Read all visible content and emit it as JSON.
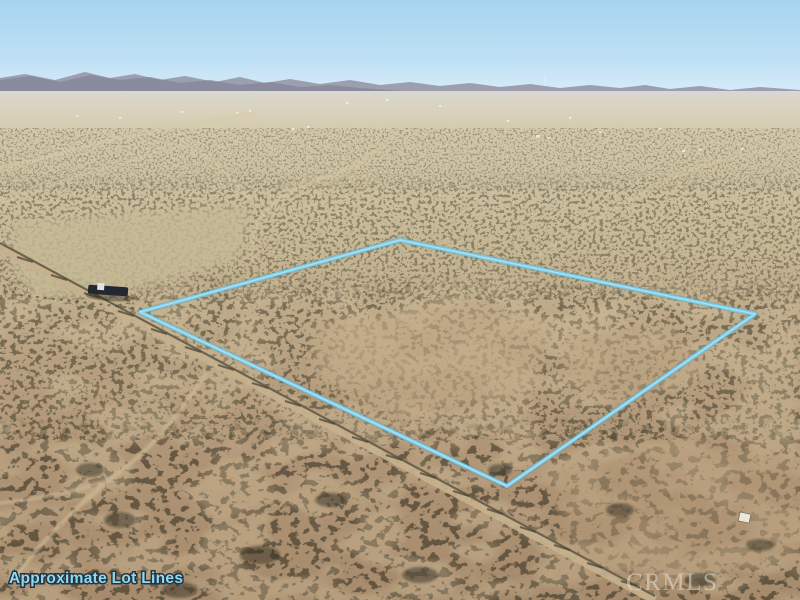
{
  "photo": {
    "type": "aerial-drone-photo",
    "description": "Aerial drone view of a vacant desert land parcel with mountains on the horizon, dirt roads, scattered scrub brush, and an outlined lot boundary",
    "overlay_label": "Approximate Lot Lines",
    "watermark": "CRMLS",
    "colors": {
      "lot_line": "#79cbe8",
      "lot_line_highlight": "#b4e4f4",
      "label_text": "#8ed9f4",
      "label_outline": "#26343f",
      "watermark_text": "#e8e8e4",
      "sky_top": "#a8d5ef",
      "sky_horizon": "#d9ecf9",
      "mountains": "#9b9aad",
      "sand_far": "#d2c8aa",
      "sand_near": "#a68b6c",
      "scrub_dark": "#3a3525"
    }
  }
}
